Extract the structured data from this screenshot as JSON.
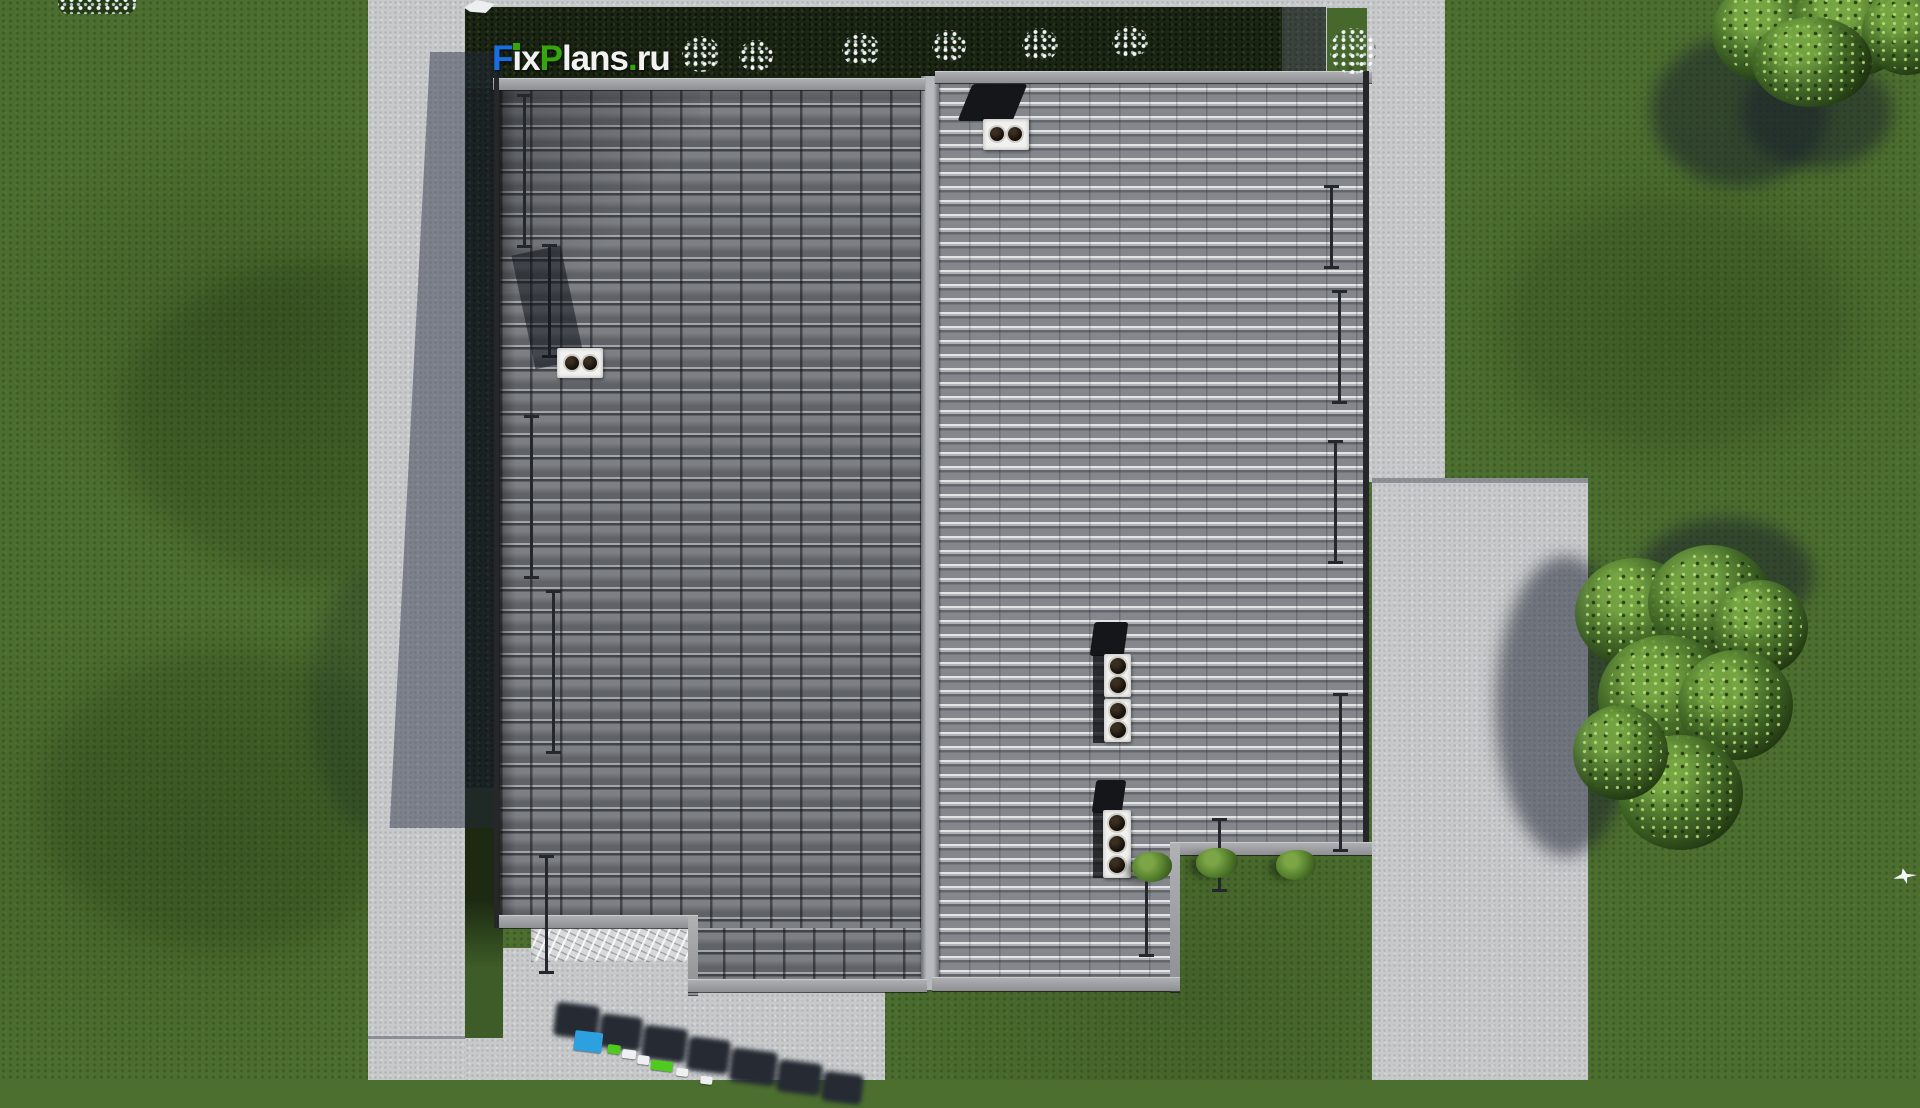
{
  "brand": {
    "text": "FixPlans.ru",
    "segments": {
      "f": "F",
      "i": "i",
      "x": "x",
      "p": "P",
      "lans": "lans",
      "dot": ".",
      "ru": "ru"
    },
    "colors": {
      "blue": "#1a6fe0",
      "green": "#36a60f",
      "white": "#f2f2f2"
    }
  },
  "watermark_3d": {
    "text": "FixPlans",
    "visibility": "partial, cut off at bottom edge",
    "colors": {
      "blue": "#2da0e0",
      "green": "#4fca1e",
      "white": "#eef0f2",
      "dark": "#252a33"
    }
  },
  "palette": {
    "grass": "#4c6e2f",
    "grass_shaded": "#3e5c27",
    "hedge": "#1b2513",
    "pavement": "#c7c9cb",
    "cast_shadow": "rgba(36,42,64,0.45)",
    "roof_left_tiles": "#74777d",
    "roof_right_tiles": "#8b8e93",
    "ridge": "#b6b9bd",
    "fascia": "#9a9ca0",
    "vent_box": "#f1f1ef",
    "vent_hole": "#150f09",
    "tree_foliage": "#3a5c24"
  },
  "scene": {
    "type": "aerial-roof-plan-render",
    "counts": {
      "roof_sections": 2,
      "roof_vent_boxes": 5,
      "vent_holes": 11,
      "snow_rails": 9,
      "hedge_flower_bushes": 7,
      "ground_bushes": 3,
      "trees": 2,
      "birds": 1
    }
  }
}
